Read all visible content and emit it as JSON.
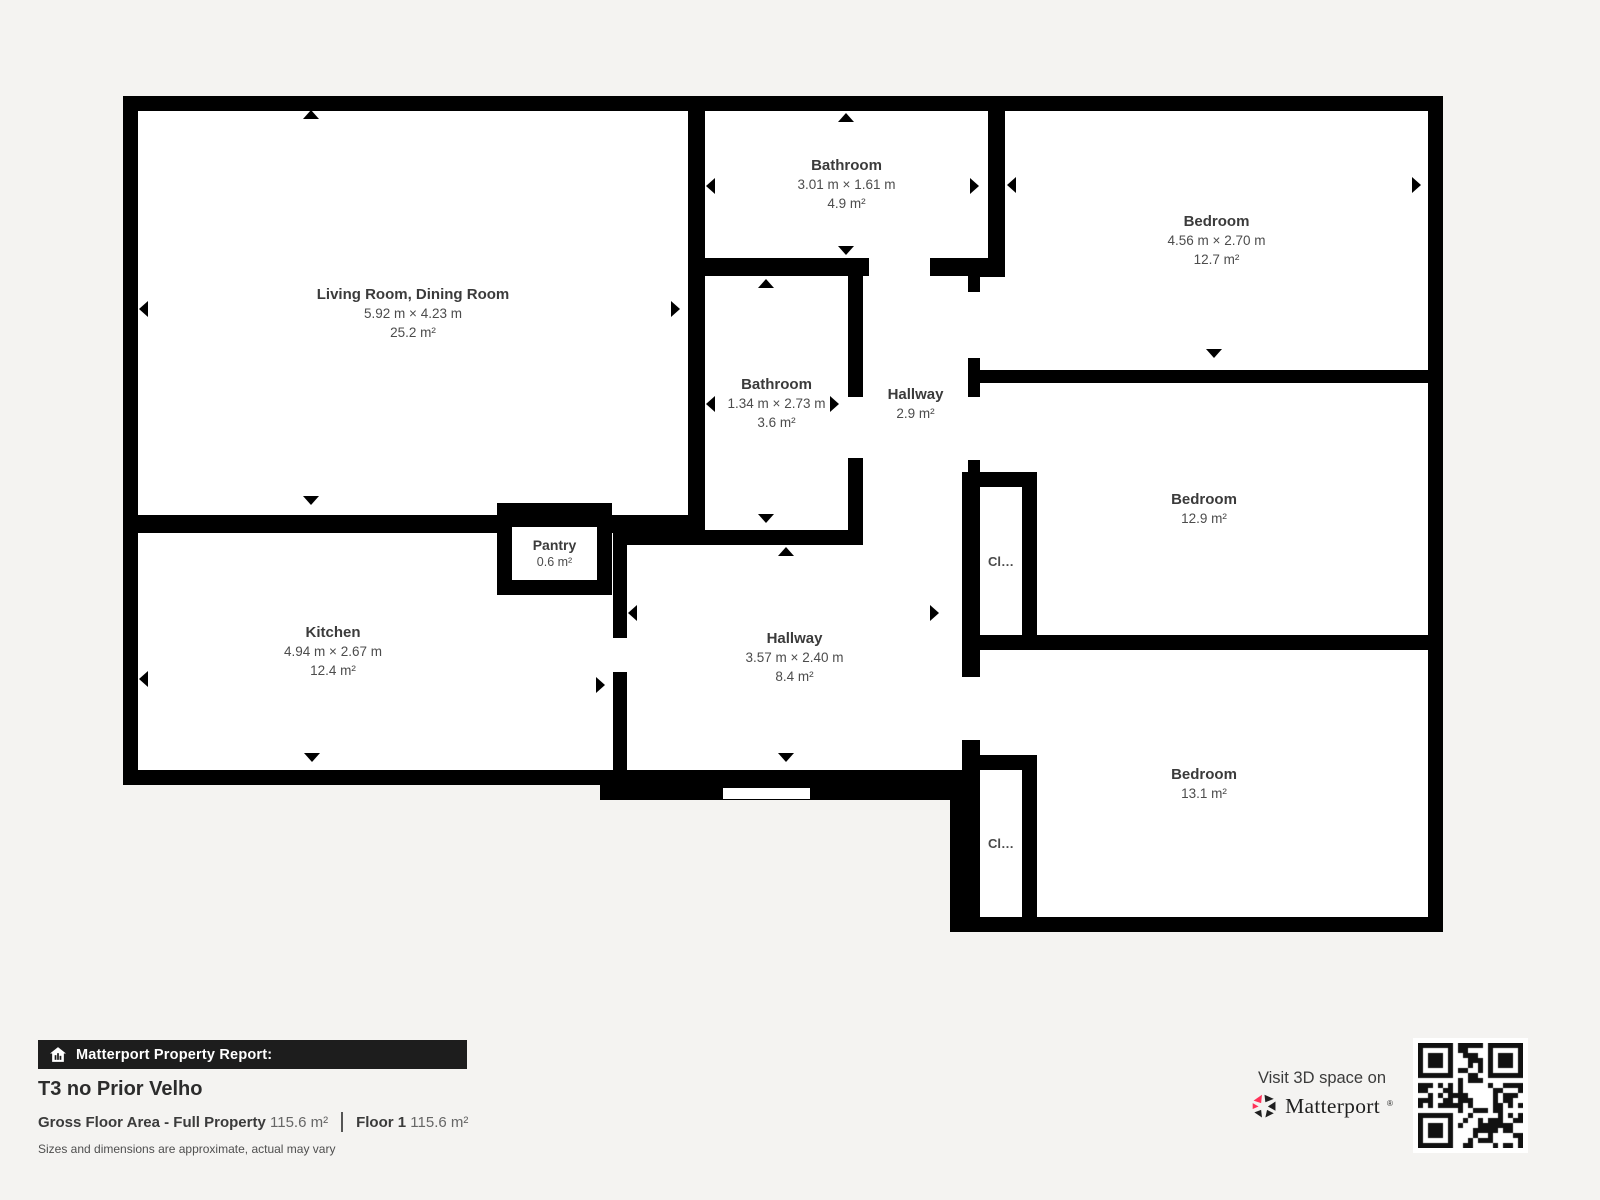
{
  "colors": {
    "background": "#f4f3f1",
    "wall": "#000000",
    "room_fill": "#ffffff",
    "text": "#3b3b3b",
    "accent_pink": "#ff3158",
    "footer_bar_bg": "#1d1d1d"
  },
  "icons": {
    "report_bar": "house-chart-icon",
    "brand": "matterport-pinwheel-icon",
    "qr": "qr-code",
    "dimension_markers": "triangle-arrows"
  },
  "rooms": {
    "living": {
      "name": "Living Room, Dining Room",
      "dims": "5.92 m × 4.23 m",
      "area": "25.2 m²"
    },
    "bathroom_top": {
      "name": "Bathroom",
      "dims": "3.01 m × 1.61 m",
      "area": "4.9 m²"
    },
    "bedroom_top_right": {
      "name": "Bedroom",
      "dims": "4.56 m × 2.70 m",
      "area": "12.7 m²"
    },
    "bathroom_mid": {
      "name": "Bathroom",
      "dims": "1.34 m × 2.73 m",
      "area": "3.6 m²"
    },
    "hallway_mid": {
      "name": "Hallway",
      "area": "2.9 m²"
    },
    "bedroom_right": {
      "name": "Bedroom",
      "area": "12.9 m²"
    },
    "kitchen": {
      "name": "Kitchen",
      "dims": "4.94 m × 2.67 m",
      "area": "12.4 m²"
    },
    "pantry": {
      "name": "Pantry",
      "area": "0.6 m²"
    },
    "hallway_bottom": {
      "name": "Hallway",
      "dims": "3.57 m × 2.40 m",
      "area": "8.4 m²"
    },
    "bedroom_bottom_right": {
      "name": "Bedroom",
      "area": "13.1 m²"
    },
    "closet_upper": {
      "name": "Cl…"
    },
    "closet_lower": {
      "name": "Cl…"
    }
  },
  "footer": {
    "report_label": "Matterport Property Report:",
    "property_title": "T3 no Prior Velho",
    "gross_label": "Gross Floor Area - Full Property",
    "gross_value": "115.6 m²",
    "floor_label": "Floor 1",
    "floor_value": "115.6 m²",
    "disclaimer": "Sizes and dimensions are approximate, actual may vary",
    "visit_label": "Visit 3D space on",
    "brand": "Matterport",
    "brand_mark": "®"
  }
}
